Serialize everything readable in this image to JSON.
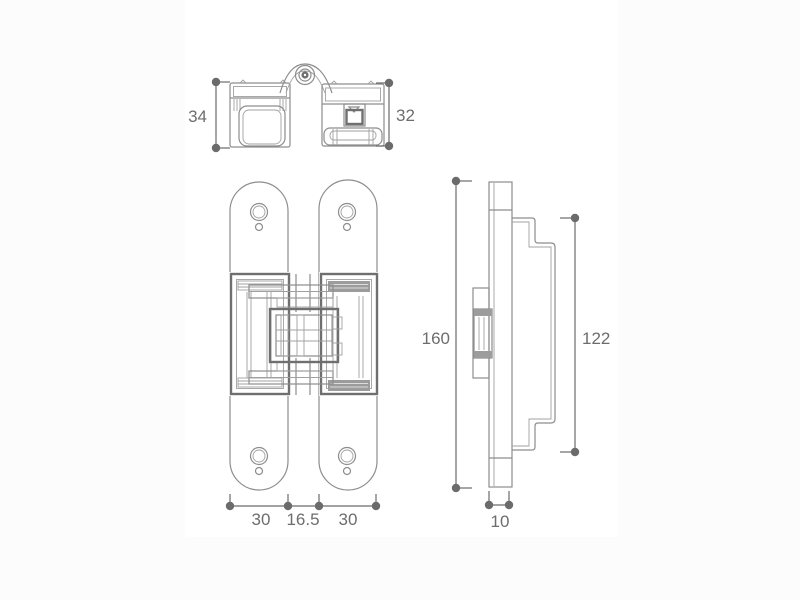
{
  "page": {
    "background_color": "#fcfcfc",
    "canvas_color": "#ffffff",
    "line_color": "#8d8d8d",
    "dark_line_color": "#6f6f6f",
    "label_color": "#6d6d6d"
  },
  "drawing": {
    "dimensions": {
      "top_view_left_height": "34",
      "top_view_right_height": "32",
      "front_view_height": "160",
      "side_view_inner_height": "122",
      "front_view_left_plate_width": "30",
      "front_view_center_gap": "16.5",
      "front_view_right_plate_width": "30",
      "side_view_thickness": "10"
    }
  }
}
